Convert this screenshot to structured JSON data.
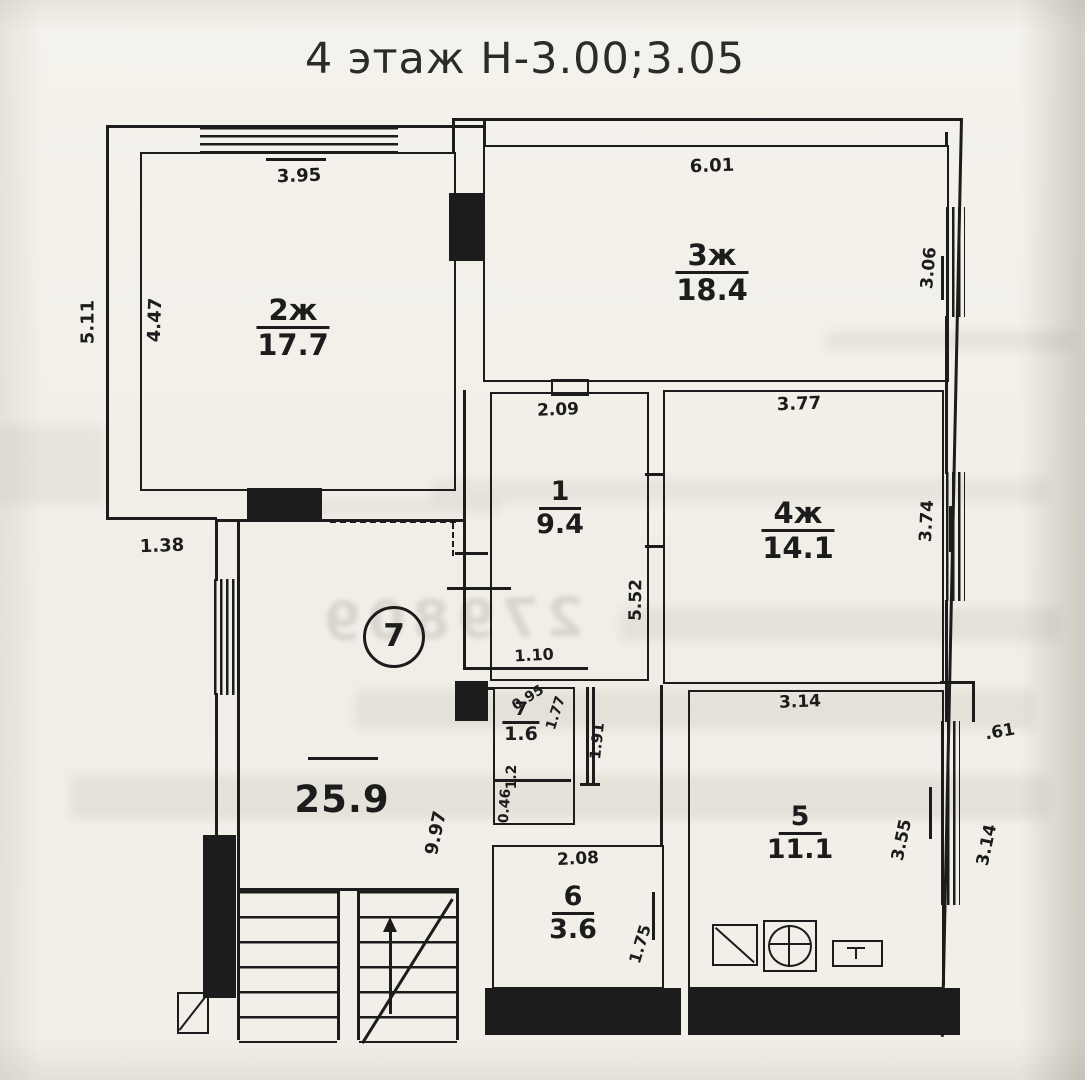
{
  "title": "4 этаж Н-3.00;3.05",
  "plan": {
    "unit_number": "7",
    "hall_area": "25.9",
    "rooms": [
      {
        "id": "room2",
        "num": "2ж",
        "area": "17.7"
      },
      {
        "id": "room3",
        "num": "3ж",
        "area": "18.4"
      },
      {
        "id": "room1",
        "num": "1",
        "area": "9.4"
      },
      {
        "id": "room4",
        "num": "4ж",
        "area": "14.1"
      },
      {
        "id": "room7",
        "num": "7",
        "area": "1.6"
      },
      {
        "id": "room5",
        "num": "5",
        "area": "11.1"
      },
      {
        "id": "room6",
        "num": "6",
        "area": "3.6"
      }
    ],
    "dimensions": [
      {
        "name": "room2-width",
        "text": "3.95"
      },
      {
        "name": "outer-left-height",
        "text": "5.11"
      },
      {
        "name": "room2-height",
        "text": "4.47"
      },
      {
        "name": "room3-width",
        "text": "6.01"
      },
      {
        "name": "room3-window",
        "text": "3.06"
      },
      {
        "name": "room1-width",
        "text": "2.09"
      },
      {
        "name": "room4-width",
        "text": "3.77"
      },
      {
        "name": "room4-window",
        "text": "3.74"
      },
      {
        "name": "room1-wall-height",
        "text": "5.52"
      },
      {
        "name": "left-step",
        "text": "1.38"
      },
      {
        "name": "room7-step",
        "text": "1.10"
      },
      {
        "name": "room7-width",
        "text": "0.95"
      },
      {
        "name": "room7-height",
        "text": "1.77"
      },
      {
        "name": "room7-wall",
        "text": "1.91"
      },
      {
        "name": "niche-width",
        "text": "1.2"
      },
      {
        "name": "niche-height",
        "text": "0.46"
      },
      {
        "name": "hall-height",
        "text": "9.97"
      },
      {
        "name": "room6-width",
        "text": "2.08"
      },
      {
        "name": "room6-height",
        "text": "1.75"
      },
      {
        "name": "room5-width",
        "text": "3.14"
      },
      {
        "name": "room5-inner-height",
        "text": "3.55"
      },
      {
        "name": "wall-notch",
        "text": ".61"
      },
      {
        "name": "room5-outer-height",
        "text": "3.14"
      }
    ]
  },
  "artifacts": {
    "ghost_digits": "279809"
  },
  "colors": {
    "ink": "#1c1c1c",
    "paper": "#f2efe8"
  }
}
